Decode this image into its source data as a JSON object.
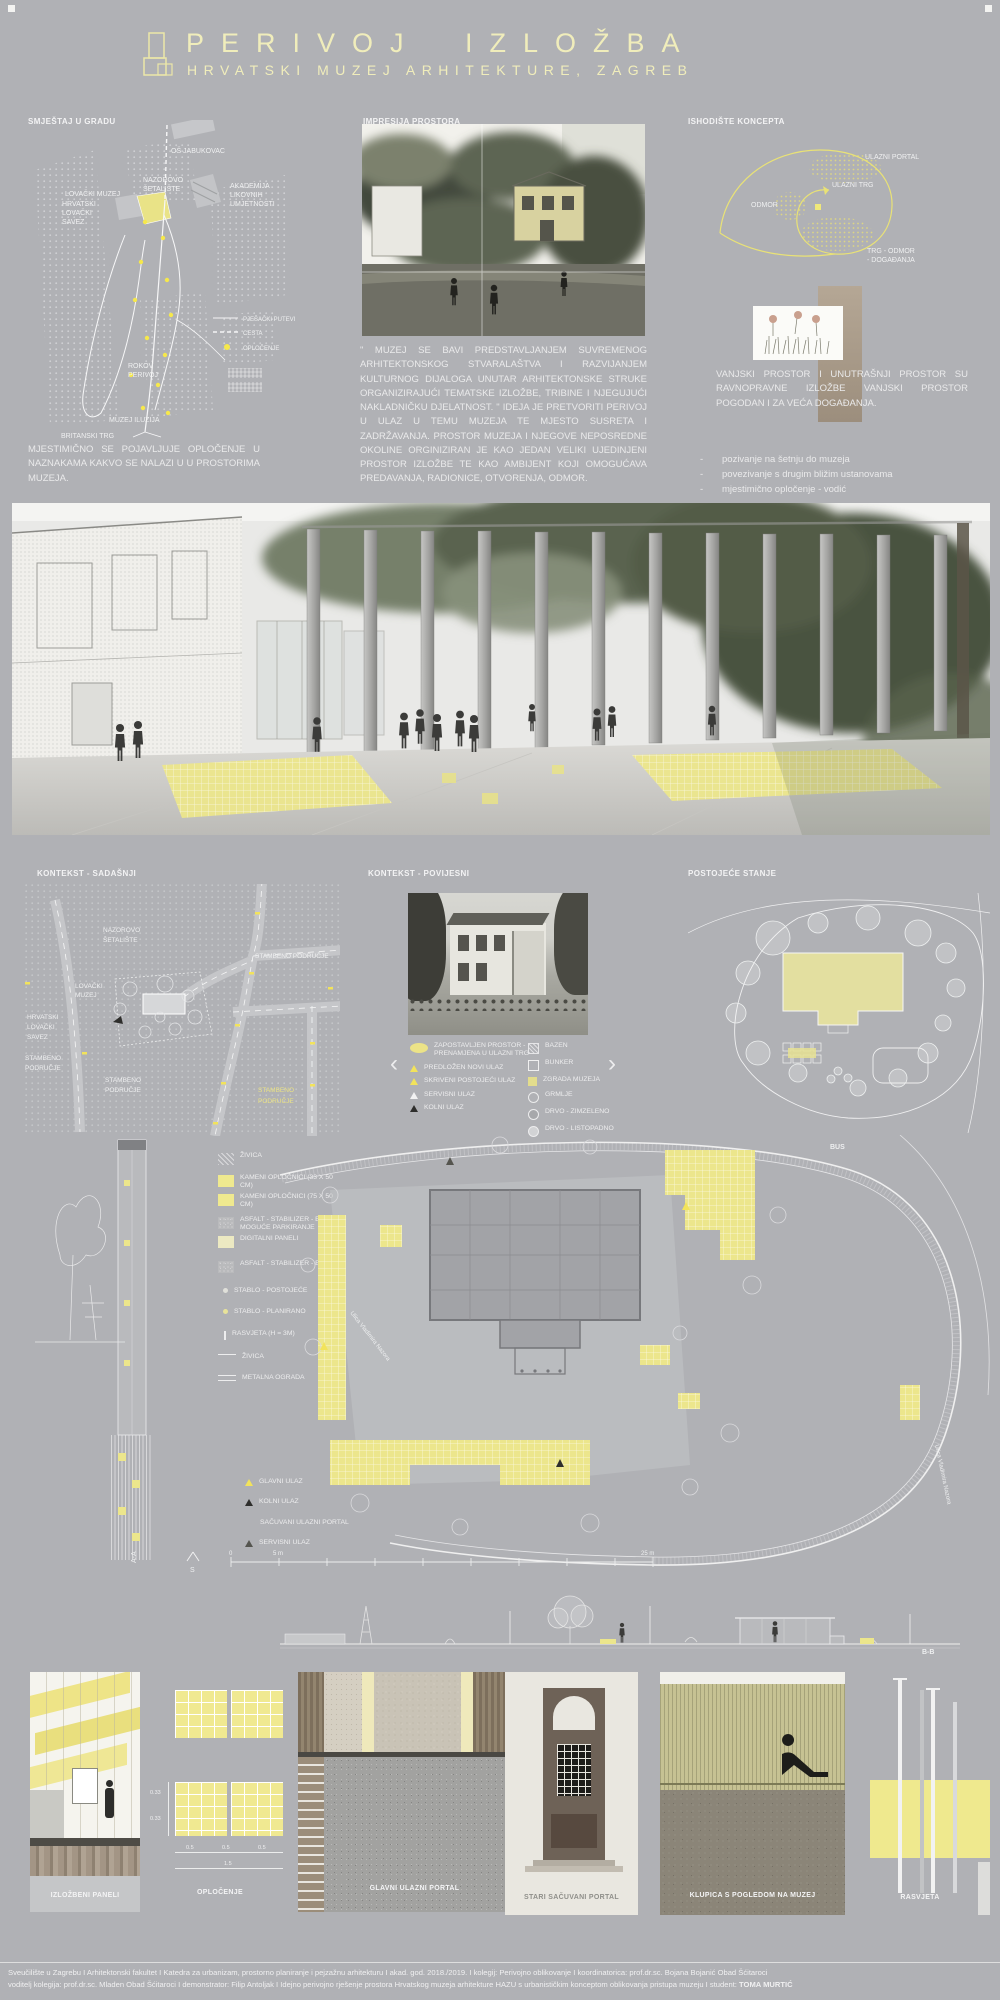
{
  "colors": {
    "board": "#b0b1b5",
    "title_yellow": "#f0edbb",
    "accent_yellow": "#f6e84b",
    "paving_yellow": "#ece68c",
    "text_white": "#f2f2f3"
  },
  "header": {
    "title": "PERIVOJ IZLOŽBA",
    "subtitle": "HRVATSKI MUZEJ ARHITEKTURE, ZAGREB"
  },
  "s1_left": {
    "heading": "SMJEŠTAJ U GRADU",
    "map": {
      "os": "OŠ JABUKOVAC",
      "nazorovo": [
        "NAZOROVO",
        "ŠETALIŠTE"
      ],
      "lovacki": [
        "LOVAČKI MUZEJ",
        "HRVATSKI",
        "LOVAČKI",
        "SAVEZ"
      ],
      "akademija": [
        "AKADEMIJA",
        "LIKOVNIH",
        "UMJETNOSTI"
      ],
      "rokov": [
        "ROKOV",
        "PERIVOJ"
      ],
      "iluzija": "MUZEJ ILUZIJA",
      "britanski": "BRITANSKI TRG"
    },
    "legend": [
      {
        "icon": "solid-line",
        "label": "PJEŠAČKI PUTEVI"
      },
      {
        "icon": "dashed-line",
        "label": "CESTA"
      },
      {
        "icon": "yellow-dot",
        "label": "OPLOČENJE"
      }
    ],
    "note": "MJESTIMIČNO SE POJAVLJUJE OPLOČENJE U NAZNAKAMA KAKVO SE NALAZI U U PROSTORIMA MUZEJA."
  },
  "s1_mid": {
    "heading": "IMPRESIJA PROSTORA",
    "paragraph": "\" MUZEJ SE BAVI PREDSTAVLJANJEM SUVREMENOG ARHITEKTONSKOG STVARALAŠTVA I RAZVIJANJEM KULTURNOG DIJALOGA UNUTAR ARHITEKTONSKE STRUKE ORGANIZIRAJUĆI TEMATSKE IZLOŽBE, TRIBINE I NJEGUJUĆI NAKLADNIČKU DJELATNOST. \" IDEJA JE PRETVORITI PERIVOJ U ULAZ U TEMU MUZEJA TE MJESTO SUSRETA I ZADRŽAVANJA. PROSTOR MUZEJA I NJEGOVE NEPOSREDNE OKOLINE ORGINIZIRAN JE KAO JEDAN VELIKI UJEDINJENI PROSTOR IZLOŽBE TE KAO AMBIJENT KOJI OMOGUĆAVA PREDAVANJA, RADIONICE, OTVORENJA, ODMOR."
  },
  "s1_right": {
    "heading": "ISHODIŠTE KONCEPTA",
    "diagram": {
      "portal": "ULAZNI PORTAL",
      "trg": "ULAZNI TRG",
      "odmor": "ODMOR",
      "trg_odmor": [
        "TRG - ODMOR",
        "- DOGAĐANJA"
      ]
    },
    "paragraph": "VANJSKI PROSTOR I UNUTRAŠNJI PROSTOR SU RAVNOPRAVNE IZLOŽBE VANJSKI PROSTOR POGODAN I ZA VEĆA DOGAĐANJA.",
    "dash": "-",
    "bullets": [
      "pozivanje na šetnju do muzeja",
      "povezivanje s drugim bližim ustanovama",
      "mjestimično opločenje - vodić"
    ]
  },
  "s2_left": {
    "heading": "KONTEKST - SADAŠNJI",
    "labels": {
      "nazorovo": [
        "NAZOROVO",
        "ŠETALIŠTE"
      ],
      "stambeno_ne": "STAMBENO PODRUČJE",
      "lovacki": [
        "LOVAČKI",
        "MUZEJ"
      ],
      "savez": [
        "HRVATSKI",
        "LOVAČKI",
        "SAVEZ"
      ],
      "stambeno_w": [
        "STAMBENO",
        "PODRUČJE"
      ],
      "stambeno_s": [
        "STAMBENO",
        "PODRUČJE"
      ],
      "stambeno_se": [
        "STAMBENO",
        "PODRUČJE"
      ]
    }
  },
  "s2_mid": {
    "heading": "KONTEKST - POVIJESNI",
    "prev_icon": "‹",
    "next_icon": "›",
    "legend_left": [
      {
        "icon": "yellow-ellipse",
        "label": "ZAPOSTAVLJEN PROSTOR - PRENAMJENA U ULAZNI TRG"
      },
      {
        "icon": "yellow-triangle",
        "label": "PREDLOŽEN NOVI ULAZ"
      },
      {
        "icon": "yellow-triangle",
        "label": "SKRIVENI POSTOJEĆI ULAZ"
      },
      {
        "icon": "white-triangle",
        "label": "SERVISNI ULAZ"
      },
      {
        "icon": "black-triangle",
        "label": "KOLNI ULAZ"
      }
    ],
    "legend_right": [
      {
        "icon": "hatched-square",
        "label": "BAZEN"
      },
      {
        "icon": "outline-square",
        "label": "BUNKER"
      },
      {
        "icon": "yellow-square",
        "label": "ZGRADA MUZEJA"
      },
      {
        "icon": "double-circle",
        "label": "GRMLJE"
      },
      {
        "icon": "gray-circle",
        "label": "DRVO - ZIMZELENO"
      },
      {
        "icon": "light-circle",
        "label": "DRVO - LISTOPADNO"
      }
    ]
  },
  "s2_right": {
    "heading": "POSTOJEĆE STANJE"
  },
  "plan": {
    "legend": [
      {
        "icon": "hatch-swatch",
        "label": "ŽIVICA"
      },
      {
        "icon": "yellow-swatch",
        "label": "KAMENI OPLOČNICI (33 X 50 CM)"
      },
      {
        "icon": "yellow-swatch",
        "label": "KAMENI OPLOČNICI (75 X 50 CM)"
      },
      {
        "icon": "speckle-swatch",
        "label": "ASFALT - STABILIZER - ECO MOGUĆE PARKIRANJE"
      },
      {
        "icon": "pale-yellow-swatch",
        "label": "DIGITALNI PANELI"
      },
      {
        "icon": "speckle-swatch",
        "label": "ASFALT - STABILIZER - ECO"
      },
      {
        "icon": "tree-dot",
        "label": "STABLO - POSTOJEĆE"
      },
      {
        "icon": "tree-dot",
        "label": "STABLO - PLANIRANO"
      },
      {
        "icon": "lamp",
        "label": "RASVJETA (H = 3M)"
      },
      {
        "icon": "line",
        "label": "ŽIVICA"
      },
      {
        "icon": "double-line",
        "label": "METALNA OGRADA"
      }
    ],
    "entrances": [
      {
        "icon": "yellow-triangle",
        "label": "GLAVNI ULAZ"
      },
      {
        "icon": "black-triangle",
        "label": "KOLNI ULAZ"
      },
      {
        "icon": "none",
        "label": "SAČUVANI ULAZNI PORTAL"
      },
      {
        "icon": "dark-triangle",
        "label": "SERVISNI ULAZ"
      }
    ],
    "scale": {
      "n0": "0",
      "n5": "5 m",
      "n25": "25 m",
      "north": "S"
    },
    "bus": "BUS",
    "road": "Ulica Vladimira Nazora",
    "section_a": "A-A",
    "section_b": "B-B"
  },
  "details": {
    "panels": [
      "IZLOŽBENI PANELI",
      "OPLOČENJE",
      "GLAVNI ULAZNI PORTAL",
      "STARI SAČUVANI PORTAL",
      "KLUPICA S POGLEDOM NA MUZEJ",
      "RASVJETA"
    ],
    "dims": {
      "v1": "0.33",
      "v2": "0.33",
      "h1": "0.5",
      "h2": "0.5",
      "h3": "0.5",
      "total": "1.5"
    }
  },
  "footer": {
    "line1": "Sveučilište u Zagrebu I Arhitektonski fakultet I Katedra za urbanizam, prostorno planiranje i pejzažnu arhitekturu I akad. god. 2018./2019. I kolegij: Perivojno oblikovanje I koordinatorica: prof.dr.sc. Bojana Bojanić Obad Šćitaroci",
    "line2": "voditelj kolegija: prof.dr.sc. Mladen Obad Šćitaroci I demonstrator: Filip Antoljak I Idejno perivojno rješenje prostora Hrvatskog muzeja arhitekture HAZU s urbanističkim konceptom oblikovanja pristupa muzeju I student:",
    "student": "TOMA MURTIĆ"
  }
}
